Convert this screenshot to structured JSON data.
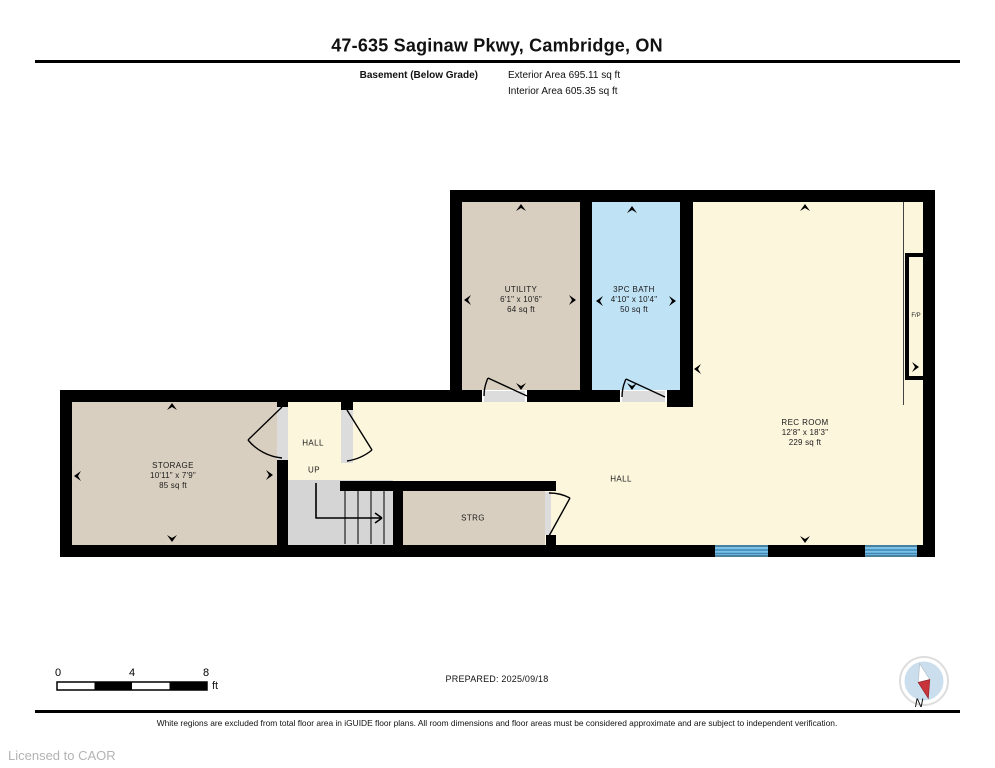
{
  "header": {
    "title": "47-635 Saginaw Pkwy, Cambridge, ON",
    "floor_label": "Basement (Below Grade)",
    "exterior_area": "Exterior Area 695.11 sq ft",
    "interior_area": "Interior Area 605.35 sq ft"
  },
  "rooms": {
    "utility": {
      "name": "UTILITY",
      "dims": "6'1\" x 10'6\"",
      "area": "64 sq ft"
    },
    "bath": {
      "name": "3PC BATH",
      "dims": "4'10\" x 10'4\"",
      "area": "50 sq ft"
    },
    "rec": {
      "name": "REC ROOM",
      "dims": "12'8\" x 18'3\"",
      "area": "229 sq ft"
    },
    "storage": {
      "name": "STORAGE",
      "dims": "10'11\" x 7'9\"",
      "area": "85 sq ft"
    },
    "hall_small": {
      "name": "HALL",
      "up": "UP"
    },
    "hall_main": {
      "name": "HALL"
    },
    "strg": {
      "name": "STRG"
    },
    "fireplace": {
      "name": "F/P"
    }
  },
  "scale_bar": {
    "tick0": "0",
    "tick4": "4",
    "tick8": "8",
    "unit": "ft"
  },
  "footer": {
    "prepared": "PREPARED: 2025/09/18",
    "compass_n": "N",
    "disclaimer": "White regions are excluded from total floor area in iGUIDE floor plans. All room dimensions and floor areas must be considered approximate and are subject to independent verification.",
    "license": "Licensed to CAOR"
  },
  "colors": {
    "wall": "#000000",
    "room_beige": "#d9cfc0",
    "room_blue": "#bfe2f5",
    "room_cream": "#fcf6dd",
    "stairs_gray": "#d5d5d5",
    "threshold_gray": "#dcdcdc",
    "window_blue": "#7bc0e5",
    "window_stripe": "#3d86b5",
    "compass_red": "#c9333b",
    "compass_disc": "#cadeee"
  }
}
